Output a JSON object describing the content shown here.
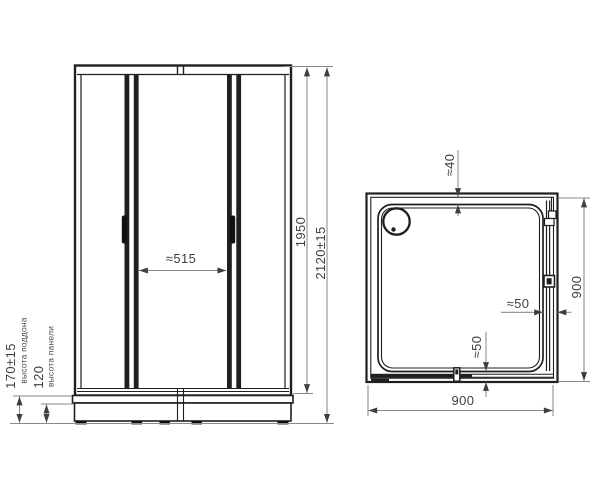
{
  "colors": {
    "object_line": "#1f1f1f",
    "dimension_line": "#8a8a8a",
    "arrow": "#3f3f3f",
    "text": "#3f3f3f",
    "background": "#ffffff"
  },
  "front_view": {
    "door_opening_width": "≈515",
    "cabin_height": "1950",
    "total_height": "2120±15",
    "tray_height": "170±15",
    "tray_height_label": "высота поддона",
    "panel_height": "120",
    "panel_height_label": "высота панели"
  },
  "top_view": {
    "top_wall_gap": "≈40",
    "right_depth": "900",
    "bottom_width": "900",
    "right_track_gap": "≈50",
    "bottom_track_gap": "≈50"
  }
}
